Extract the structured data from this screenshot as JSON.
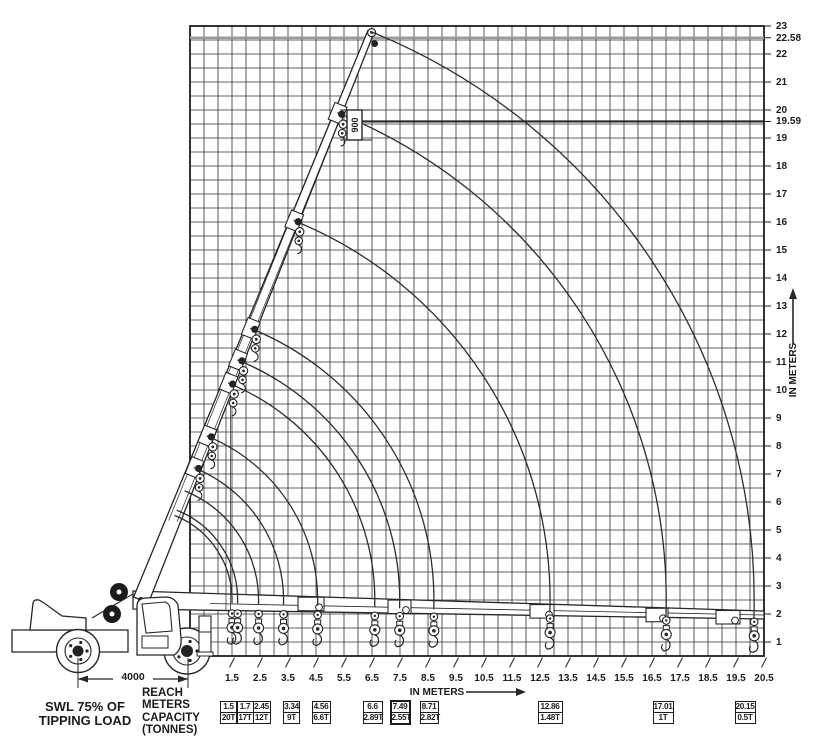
{
  "axes": {
    "x_label": "IN METERS",
    "y_label": "IN METERS",
    "x_ticks": [
      1.5,
      2.5,
      3.5,
      4.5,
      5.5,
      6.5,
      7.5,
      8.5,
      9.5,
      10.5,
      11.5,
      12.5,
      13.5,
      14.5,
      15.5,
      16.5,
      17.5,
      18.5,
      19.5,
      20.5
    ],
    "y_ticks": [
      23,
      22.58,
      22,
      21,
      20,
      19.59,
      19,
      18,
      17,
      16,
      15,
      14,
      13,
      12,
      11,
      10,
      9,
      8,
      7,
      6,
      5,
      4,
      3,
      2,
      1
    ]
  },
  "notes": {
    "swl_line1": "SWL 75% OF",
    "swl_line2": "TIPPING LOAD"
  },
  "legend": {
    "rows": [
      "REACH",
      "METERS",
      "CAPACITY",
      "(TONNES)"
    ]
  },
  "annotations": {
    "head_offset": "900",
    "wheelbase": "4000"
  },
  "capacity_table": [
    {
      "reach": "1.5",
      "capacity": "20T",
      "highlight": false
    },
    {
      "reach": "1.7",
      "capacity": "17T",
      "highlight": false
    },
    {
      "reach": "2.45",
      "capacity": "12T",
      "highlight": false
    },
    {
      "reach": "3.34",
      "capacity": "9T",
      "highlight": false
    },
    {
      "reach": "4.56",
      "capacity": "6.6T",
      "highlight": false
    },
    {
      "reach": "6.6",
      "capacity": "2.89T",
      "highlight": false
    },
    {
      "reach": "7.49",
      "capacity": "2.55T",
      "highlight": true
    },
    {
      "reach": "8.71",
      "capacity": "2.82T",
      "highlight": false
    },
    {
      "reach": "12.86",
      "capacity": "1.48T",
      "highlight": false
    },
    {
      "reach": "17.01",
      "capacity": "1T",
      "highlight": false
    },
    {
      "reach": "20.15",
      "capacity": "0.5T",
      "highlight": false
    }
  ],
  "chart_data": {
    "type": "line",
    "title": "SWL 75% OF TIPPING LOAD",
    "xlabel": "IN METERS",
    "ylabel": "IN METERS",
    "x_range": [
      0,
      20.5
    ],
    "y_range": [
      0,
      23
    ],
    "grid_step_m": 0.5,
    "series": [
      {
        "name": "REACH METERS vs CAPACITY (TONNES)",
        "x": [
          1.5,
          1.7,
          2.45,
          3.34,
          4.56,
          6.6,
          7.49,
          8.71,
          12.86,
          17.01,
          20.15
        ],
        "y": [
          20,
          17,
          12,
          9,
          6.6,
          2.89,
          2.55,
          2.82,
          1.48,
          1,
          0.5
        ]
      }
    ],
    "highlighted_point": {
      "x": 7.49,
      "y": 2.55
    },
    "reference_heights_m": [
      22.58,
      19.59
    ],
    "wheelbase_mm": 4000,
    "head_offset_mm": 900
  }
}
